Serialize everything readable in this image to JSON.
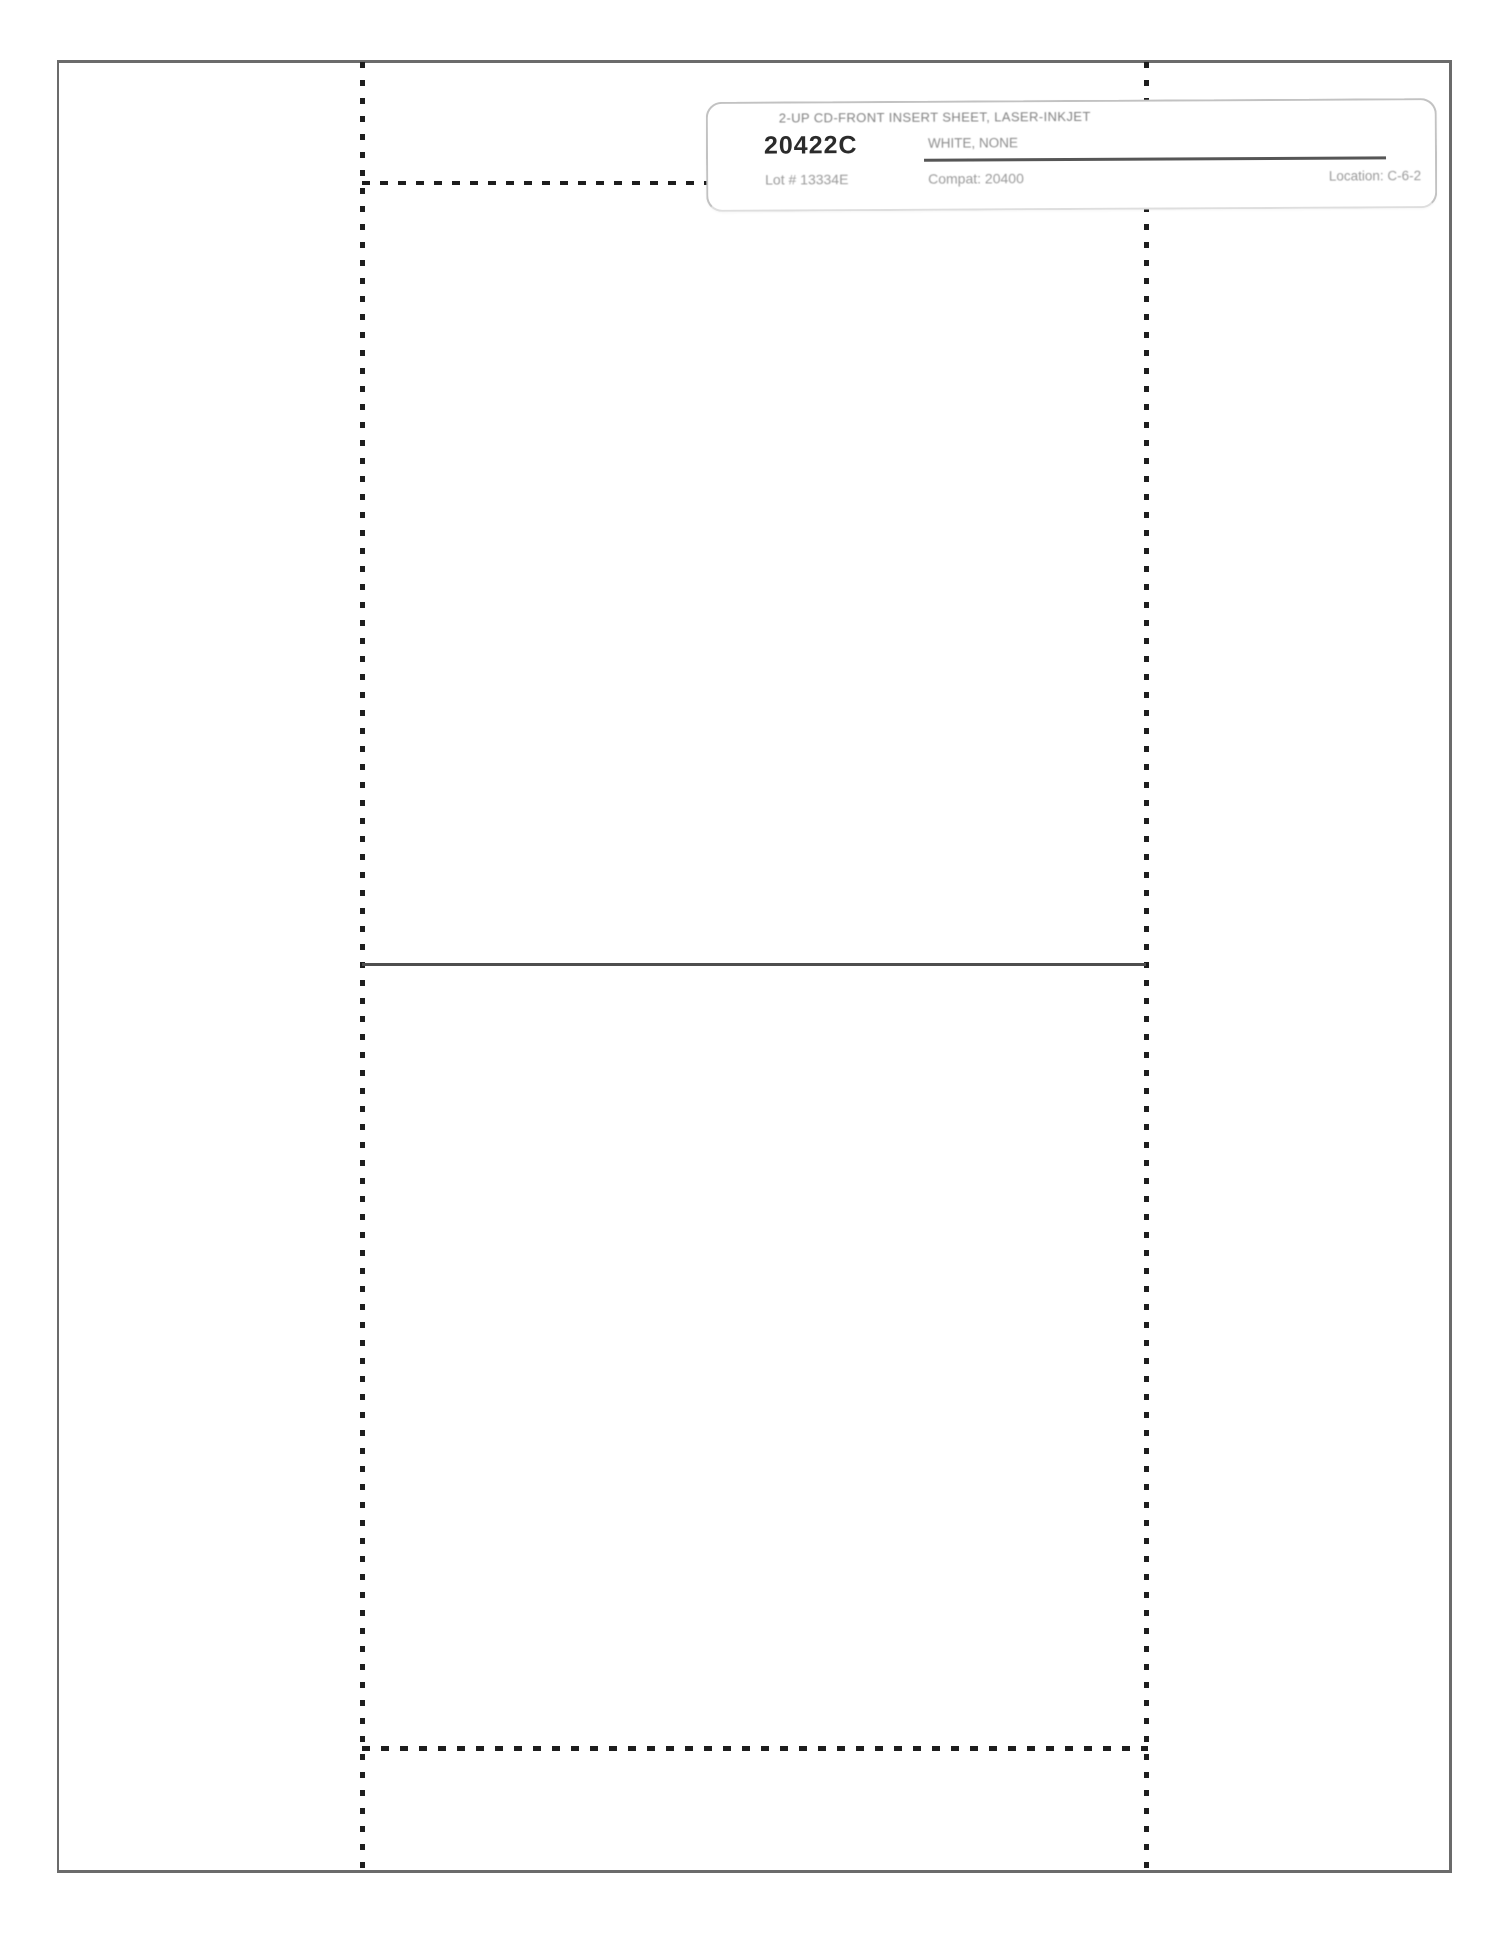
{
  "label": {
    "title": "2-UP CD-FRONT INSERT SHEET, LASER-INKJET",
    "part_number": "20422C",
    "lot_number": "Lot # 13334E",
    "stock_desc": "WHITE, NONE",
    "compat": "Compat: 20400",
    "location": "Location: C-6-2"
  },
  "colors": {
    "page_bg": "#ffffff",
    "sheet_border": "#6b6b6b",
    "perforation": "#1e1e1e",
    "fold_line": "#4e4e4e",
    "label_border": "#c2c2c2",
    "part_number_text": "#2b2b2b",
    "label_text": "#8e8e8e",
    "rule": "#565656"
  }
}
